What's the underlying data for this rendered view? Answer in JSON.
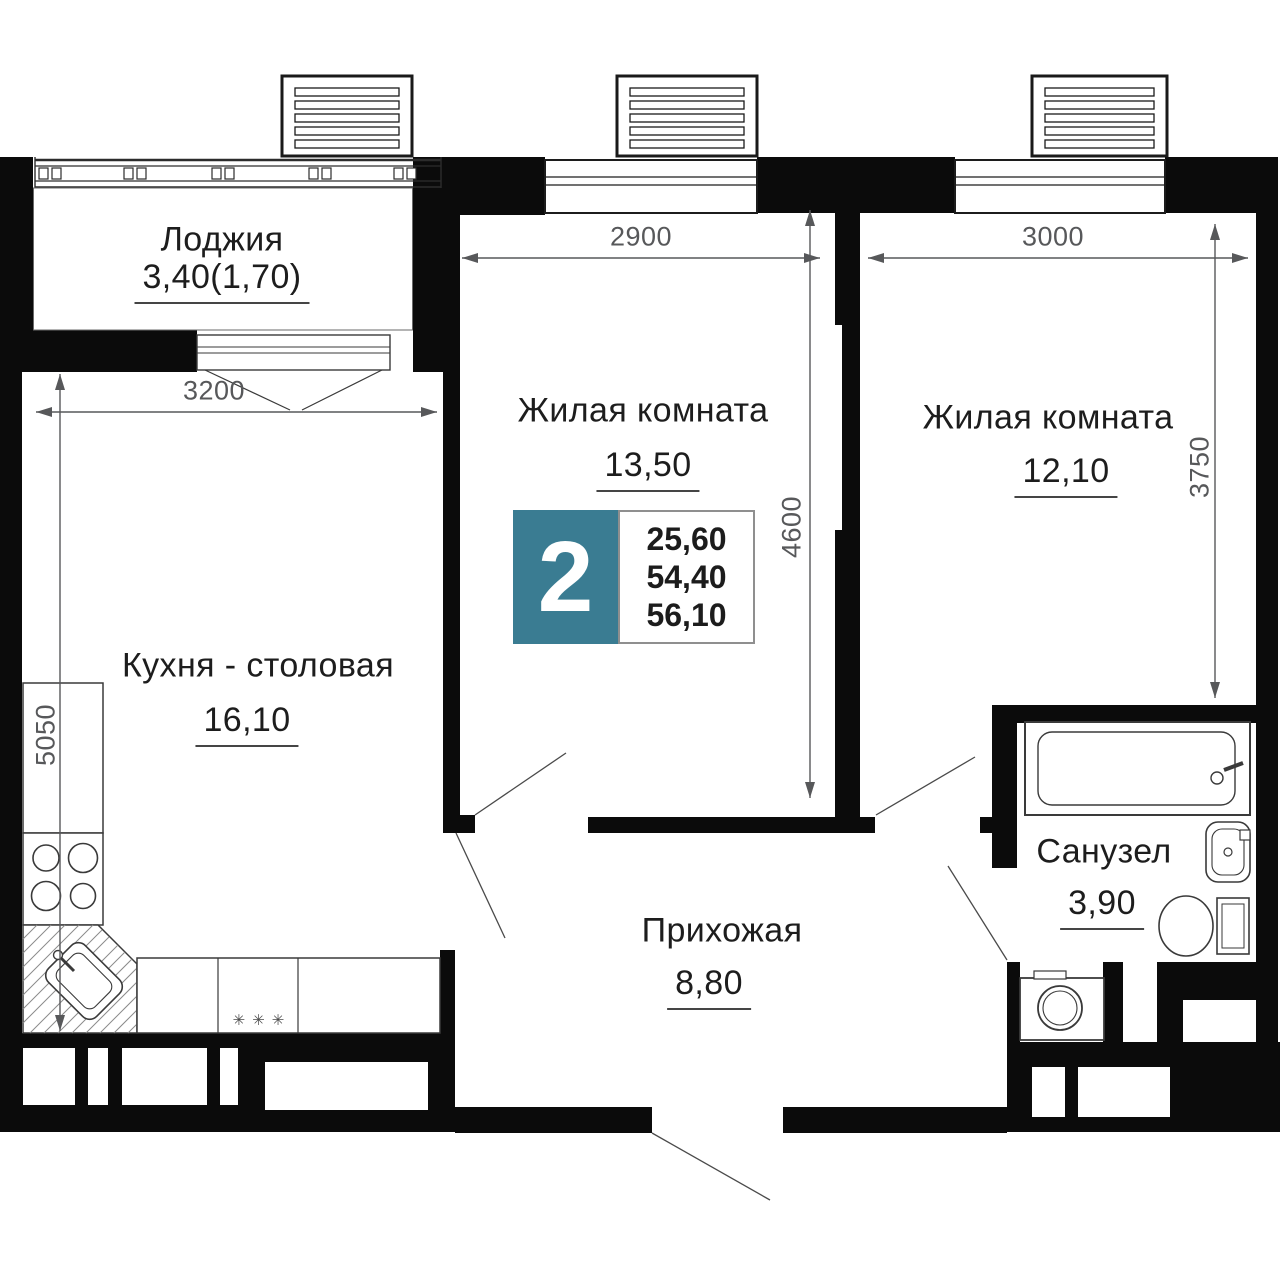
{
  "badge": {
    "rooms_count": "2",
    "values": [
      "25,60",
      "54,40",
      "56,10"
    ]
  },
  "rooms": {
    "loggia": {
      "name": "Лоджия",
      "area": "3,40(1,70)"
    },
    "kitchen": {
      "name": "Кухня - столовая",
      "area": "16,10"
    },
    "living1": {
      "name": "Жилая комната",
      "area": "13,50"
    },
    "living2": {
      "name": "Жилая комната",
      "area": "12,10"
    },
    "hall": {
      "name": "Прихожая",
      "area": "8,80"
    },
    "bath": {
      "name": "Санузел",
      "area": "3,90"
    }
  },
  "dimensions": {
    "kitchen_width": "3200",
    "kitchen_depth": "5050",
    "living1_width": "2900",
    "living1_depth": "4600",
    "living2_width": "3000",
    "living2_depth": "3750"
  },
  "symbols": {
    "counter_marks": "✳✳✳"
  },
  "colors": {
    "wall": "#0b0b0b",
    "badge_teal": "#3a7c92",
    "dimension_gray": "#57585a",
    "text": "#1d1d1d"
  }
}
